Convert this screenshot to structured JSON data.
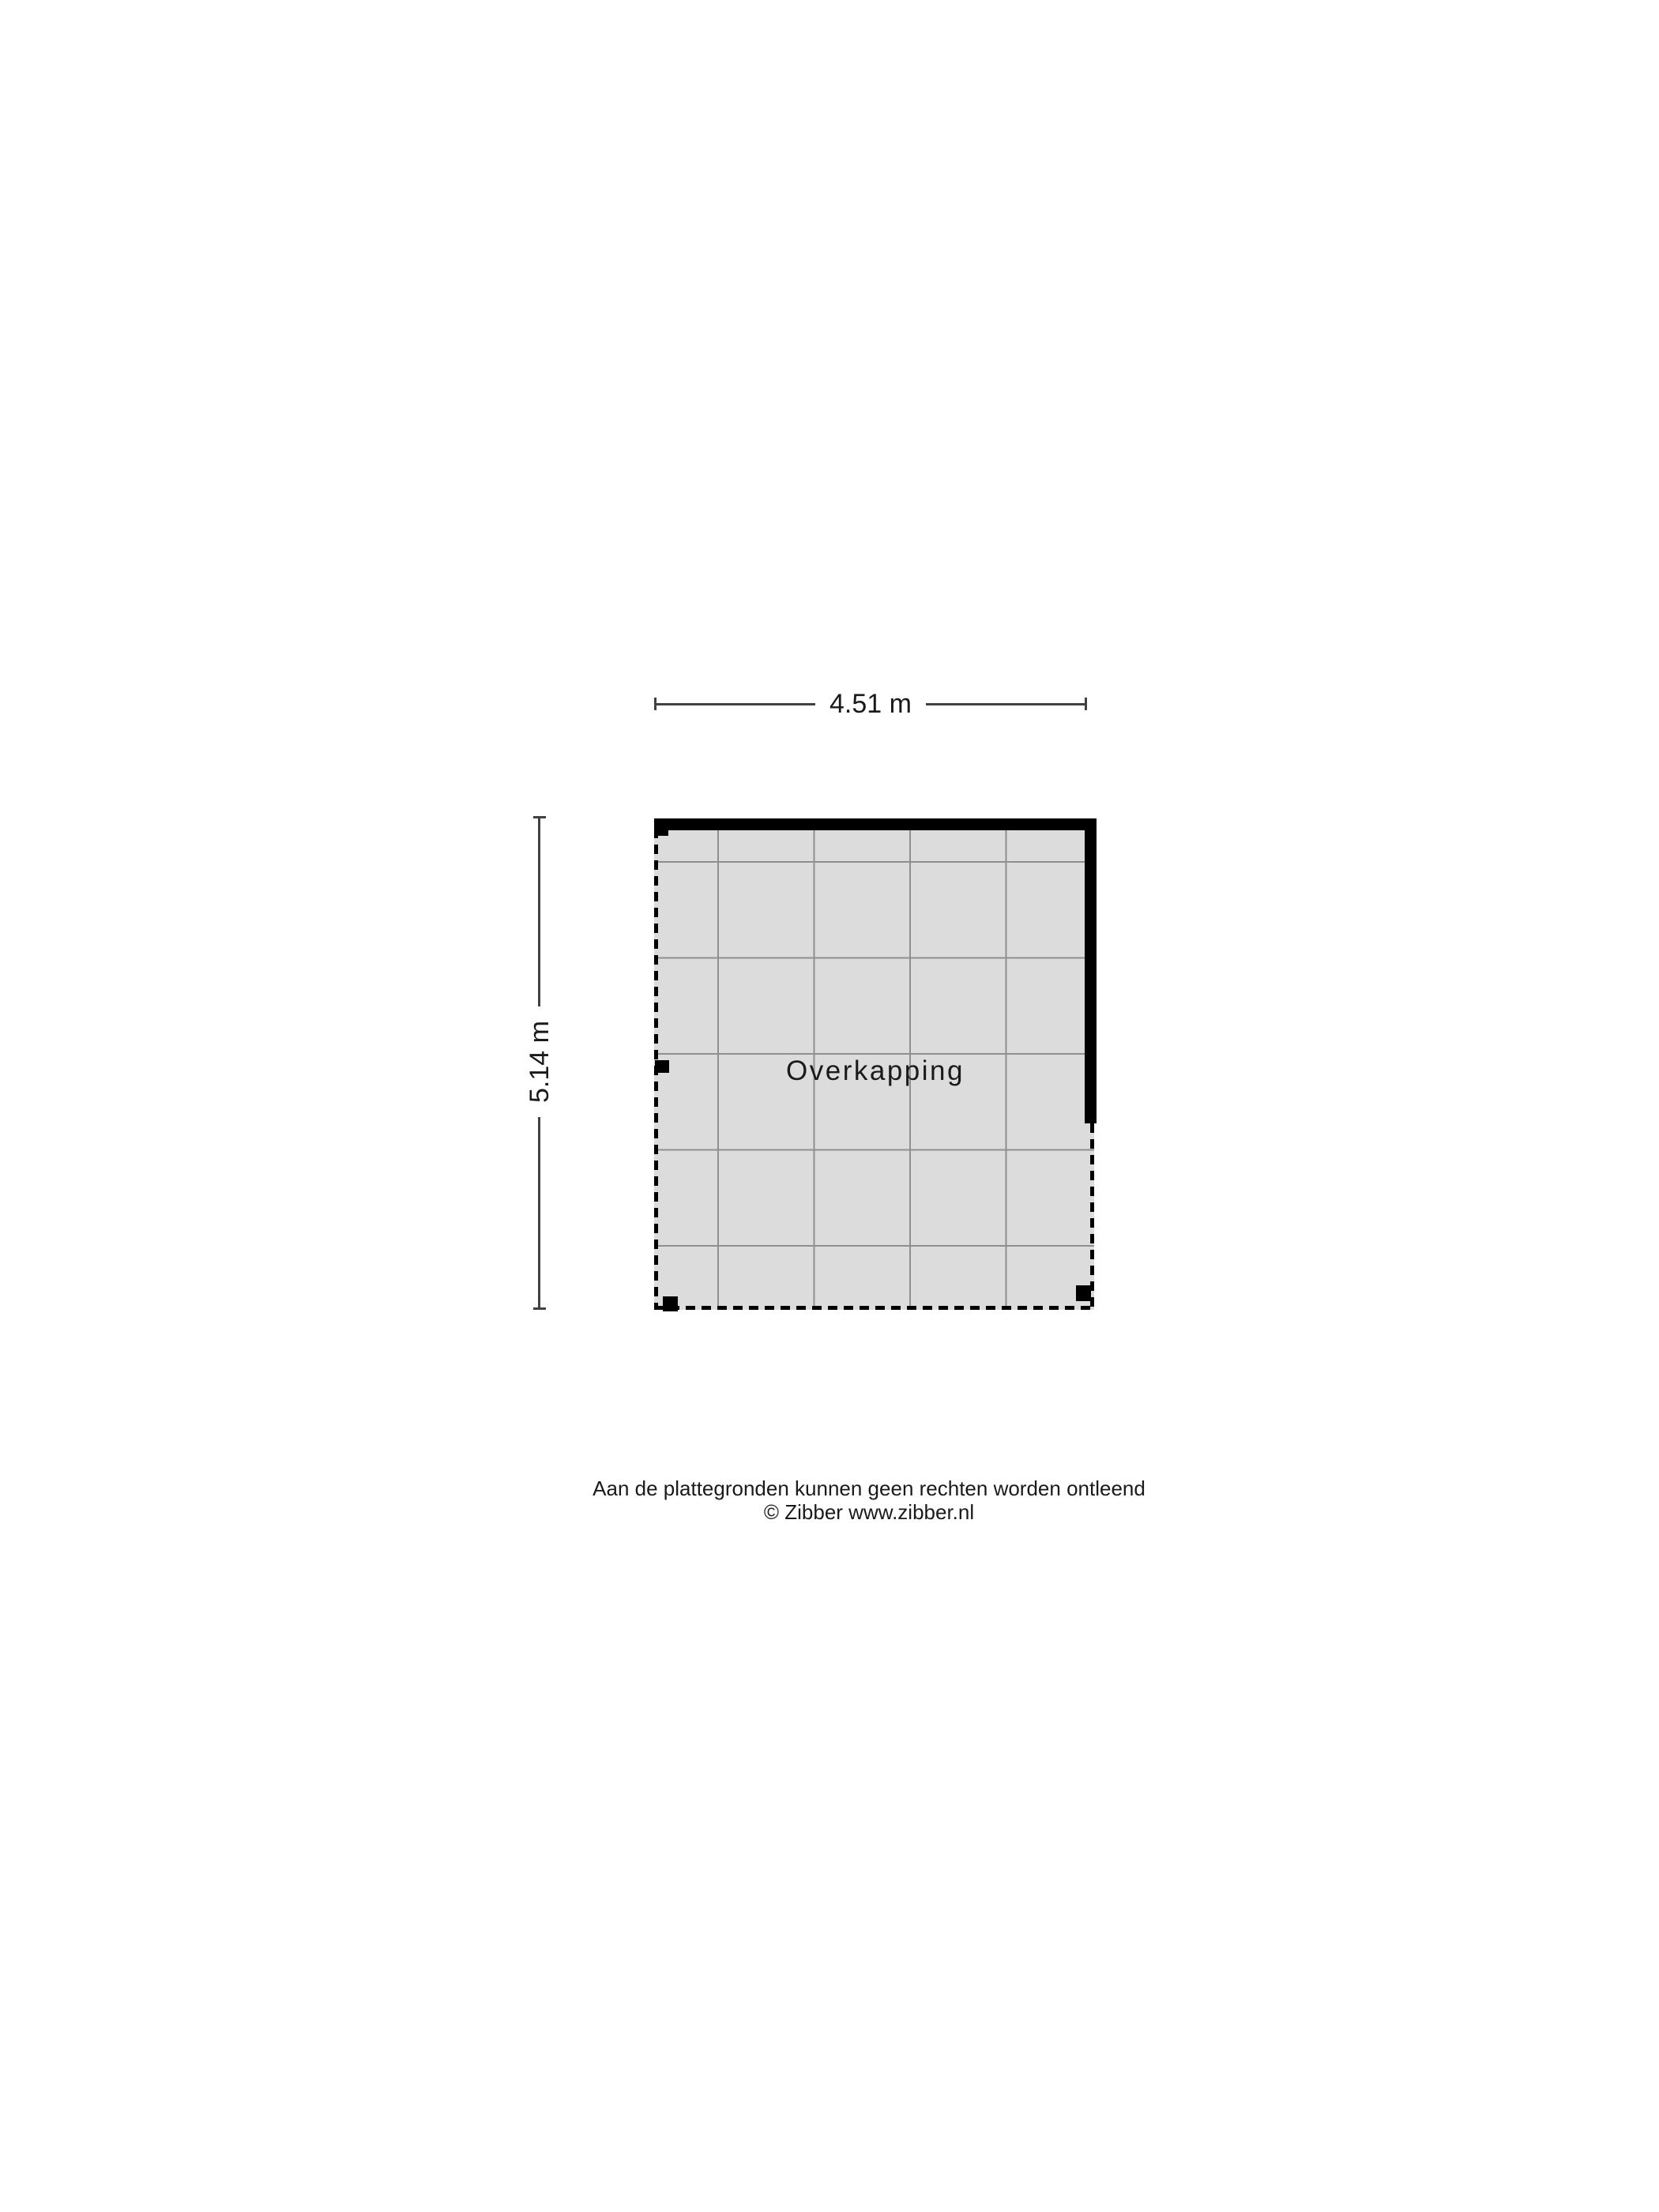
{
  "floorplan": {
    "room_label": "Overkapping",
    "width_label": "4.51 m",
    "depth_label": "5.14 m"
  },
  "footer": {
    "disclaimer": "Aan de plattegronden kunnen geen rechten worden ontleend",
    "copyright": "© Zibber www.zibber.nl"
  },
  "colors": {
    "floor_fill": "#dcdcdc",
    "grid_line": "#8f8f8f",
    "wall": "#000000",
    "boundary": "#000000",
    "dimension_line": "#414141",
    "text": "#1a1a1a"
  }
}
